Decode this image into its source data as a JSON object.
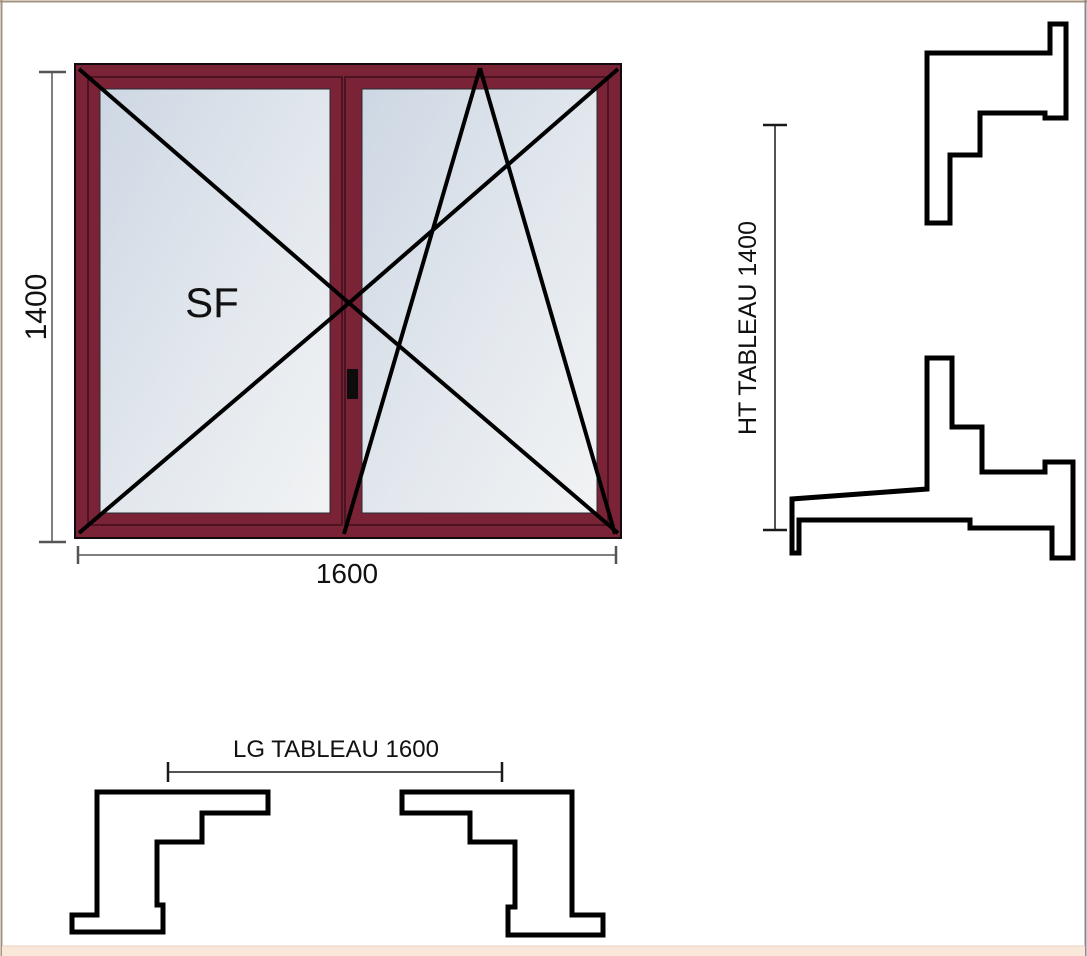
{
  "elevation": {
    "sash_label": "SF",
    "height_dim": "1400",
    "width_dim": "1600"
  },
  "sections": {
    "height_label": "HT TABLEAU 1400",
    "width_label": "LG TABLEAU 1600"
  },
  "colors": {
    "frame": "#7a2336",
    "glass_gradient_start": "#cdd7e3",
    "glass_gradient_end": "#f1f3f4",
    "opening_lines": "#000000",
    "profile_outline": "#000000",
    "dimension_line": "#555555",
    "section_dimension_line": "#1a1a1a",
    "page_border": "#a4937f",
    "bottom_strip": "#f9e7da"
  }
}
